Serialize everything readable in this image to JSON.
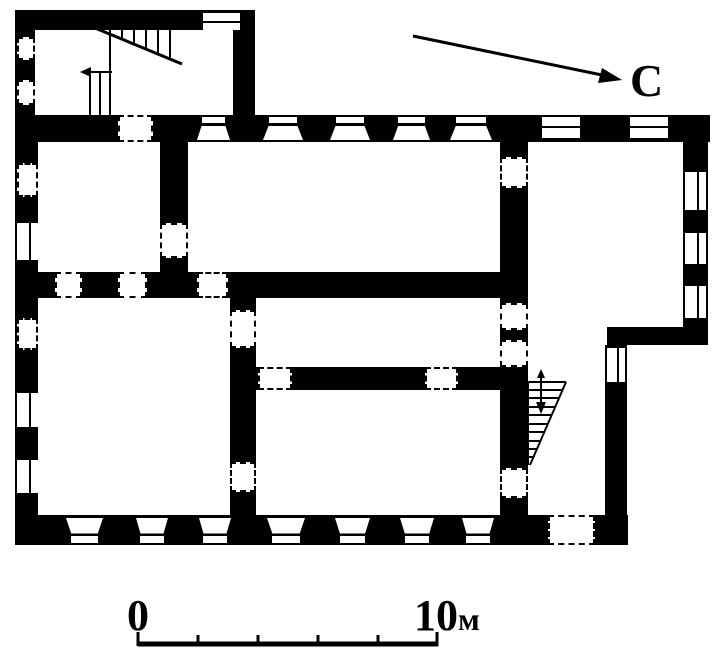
{
  "labels": {
    "north": "С",
    "scale_start": "0",
    "scale_end_num": "10",
    "scale_end_unit": "м"
  },
  "colors": {
    "ink": "#000000",
    "paper": "#ffffff"
  },
  "plan": {
    "walls": [
      {
        "x": 15,
        "y": 10,
        "w": 240,
        "h": 20
      },
      {
        "x": 15,
        "y": 10,
        "w": 20,
        "h": 107
      },
      {
        "x": 233,
        "y": 10,
        "w": 22,
        "h": 107
      },
      {
        "x": 15,
        "y": 115,
        "w": 695,
        "h": 27
      },
      {
        "x": 15,
        "y": 142,
        "w": 23,
        "h": 403
      },
      {
        "x": 683,
        "y": 142,
        "w": 25,
        "h": 188
      },
      {
        "x": 607,
        "y": 327,
        "w": 101,
        "h": 18
      },
      {
        "x": 605,
        "y": 345,
        "w": 22,
        "h": 200
      },
      {
        "x": 15,
        "y": 515,
        "w": 613,
        "h": 30
      },
      {
        "x": 160,
        "y": 142,
        "w": 28,
        "h": 156
      },
      {
        "x": 15,
        "y": 272,
        "w": 513,
        "h": 26
      },
      {
        "x": 230,
        "y": 298,
        "w": 26,
        "h": 217
      },
      {
        "x": 256,
        "y": 367,
        "w": 249,
        "h": 23
      },
      {
        "x": 500,
        "y": 142,
        "w": 28,
        "h": 373
      }
    ],
    "windows": [
      {
        "x": 197,
        "y": 117,
        "w": 33,
        "h": 23,
        "style": "trap-top"
      },
      {
        "x": 263,
        "y": 117,
        "w": 40,
        "h": 23,
        "style": "trap-top"
      },
      {
        "x": 330,
        "y": 117,
        "w": 40,
        "h": 23,
        "style": "trap-top"
      },
      {
        "x": 393,
        "y": 117,
        "w": 37,
        "h": 23,
        "style": "trap-top"
      },
      {
        "x": 450,
        "y": 117,
        "w": 42,
        "h": 23,
        "style": "trap-top"
      },
      {
        "x": 542,
        "y": 117,
        "w": 38,
        "h": 21,
        "style": "slit-h"
      },
      {
        "x": 630,
        "y": 117,
        "w": 38,
        "h": 21,
        "style": "slit-h"
      },
      {
        "x": 203,
        "y": 13,
        "w": 37,
        "h": 17,
        "style": "slit-h"
      },
      {
        "x": 685,
        "y": 172,
        "w": 21,
        "h": 38,
        "style": "slit-v"
      },
      {
        "x": 685,
        "y": 233,
        "w": 21,
        "h": 31,
        "style": "slit-v"
      },
      {
        "x": 685,
        "y": 286,
        "w": 21,
        "h": 32,
        "style": "slit-v"
      },
      {
        "x": 607,
        "y": 348,
        "w": 18,
        "h": 34,
        "style": "slit-v"
      },
      {
        "x": 17,
        "y": 223,
        "w": 21,
        "h": 37,
        "style": "slit-v"
      },
      {
        "x": 17,
        "y": 393,
        "w": 21,
        "h": 34,
        "style": "slit-v"
      },
      {
        "x": 17,
        "y": 460,
        "w": 21,
        "h": 33,
        "style": "slit-v"
      },
      {
        "x": 17,
        "y": 163,
        "w": 21,
        "h": 34,
        "style": "dash"
      },
      {
        "x": 17,
        "y": 318,
        "w": 21,
        "h": 32,
        "style": "dash"
      },
      {
        "x": 17,
        "y": 37,
        "w": 18,
        "h": 23,
        "style": "dash"
      },
      {
        "x": 17,
        "y": 80,
        "w": 18,
        "h": 25,
        "style": "dash"
      },
      {
        "x": 66,
        "y": 518,
        "w": 37,
        "h": 25,
        "style": "trap-bottom"
      },
      {
        "x": 136,
        "y": 518,
        "w": 32,
        "h": 25,
        "style": "trap-bottom"
      },
      {
        "x": 199,
        "y": 518,
        "w": 32,
        "h": 25,
        "style": "trap-bottom"
      },
      {
        "x": 267,
        "y": 518,
        "w": 38,
        "h": 25,
        "style": "trap-bottom"
      },
      {
        "x": 335,
        "y": 518,
        "w": 35,
        "h": 25,
        "style": "trap-bottom"
      },
      {
        "x": 400,
        "y": 518,
        "w": 34,
        "h": 25,
        "style": "trap-bottom"
      },
      {
        "x": 462,
        "y": 518,
        "w": 32,
        "h": 25,
        "style": "trap-bottom"
      }
    ],
    "doors": [
      {
        "x": 118,
        "y": 115,
        "w": 35,
        "h": 27
      },
      {
        "x": 55,
        "y": 272,
        "w": 27,
        "h": 26
      },
      {
        "x": 118,
        "y": 272,
        "w": 29,
        "h": 26
      },
      {
        "x": 197,
        "y": 272,
        "w": 31,
        "h": 26
      },
      {
        "x": 160,
        "y": 223,
        "w": 28,
        "h": 35
      },
      {
        "x": 500,
        "y": 157,
        "w": 28,
        "h": 31
      },
      {
        "x": 500,
        "y": 303,
        "w": 28,
        "h": 27
      },
      {
        "x": 500,
        "y": 340,
        "w": 28,
        "h": 27
      },
      {
        "x": 500,
        "y": 468,
        "w": 28,
        "h": 30
      },
      {
        "x": 230,
        "y": 310,
        "w": 26,
        "h": 38
      },
      {
        "x": 230,
        "y": 462,
        "w": 26,
        "h": 30
      },
      {
        "x": 258,
        "y": 367,
        "w": 34,
        "h": 23
      },
      {
        "x": 425,
        "y": 367,
        "w": 33,
        "h": 23
      },
      {
        "x": 548,
        "y": 515,
        "w": 47,
        "h": 30
      }
    ],
    "linework": [
      {
        "name": "annex-stairs",
        "lines": [
          [
            110,
            30,
            110,
            117,
            2
          ],
          [
            95,
            28,
            182,
            64,
            3
          ],
          [
            122,
            30,
            122,
            39,
            2
          ],
          [
            134,
            30,
            134,
            44,
            2
          ],
          [
            146,
            30,
            146,
            49,
            2
          ],
          [
            158,
            30,
            158,
            54,
            2
          ],
          [
            170,
            30,
            170,
            59,
            2
          ],
          [
            84,
            72,
            112,
            72,
            2
          ],
          [
            90,
            72,
            90,
            117,
            2
          ],
          [
            100,
            72,
            100,
            117,
            2
          ]
        ],
        "polys": [
          "80,72 91,67 91,77"
        ]
      },
      {
        "name": "stairwell-stairs",
        "lines": [
          [
            528,
            382,
            528,
            465,
            2
          ],
          [
            528,
            382,
            566,
            382,
            2
          ],
          [
            566,
            382,
            530,
            465,
            2
          ],
          [
            528,
            390,
            562,
            390,
            2
          ],
          [
            528,
            398,
            559,
            398,
            2
          ],
          [
            528,
            407,
            555,
            407,
            2
          ],
          [
            528,
            415,
            552,
            415,
            2
          ],
          [
            528,
            424,
            548,
            424,
            2
          ],
          [
            528,
            432,
            544,
            432,
            2
          ],
          [
            528,
            441,
            540,
            441,
            2
          ],
          [
            528,
            449,
            537,
            449,
            2
          ],
          [
            528,
            457,
            533,
            457,
            2
          ],
          [
            541,
            372,
            541,
            404,
            2
          ]
        ],
        "polys": [
          "536,402 546,402 541,414",
          "537,378 545,378 541,369"
        ]
      },
      {
        "name": "north-arrow",
        "lines": [
          [
            413,
            36,
            602,
            75,
            3
          ]
        ],
        "polys": [
          "622,80 598,83 602,68"
        ]
      },
      {
        "name": "scale-bar",
        "lines": [
          [
            138,
            644,
            438,
            644,
            5
          ],
          [
            138,
            632,
            138,
            646,
            3
          ],
          [
            198,
            635,
            198,
            646,
            3
          ],
          [
            258,
            635,
            258,
            646,
            3
          ],
          [
            318,
            635,
            318,
            646,
            3
          ],
          [
            378,
            635,
            378,
            646,
            3
          ],
          [
            437,
            632,
            437,
            646,
            3
          ]
        ],
        "polys": []
      }
    ]
  }
}
